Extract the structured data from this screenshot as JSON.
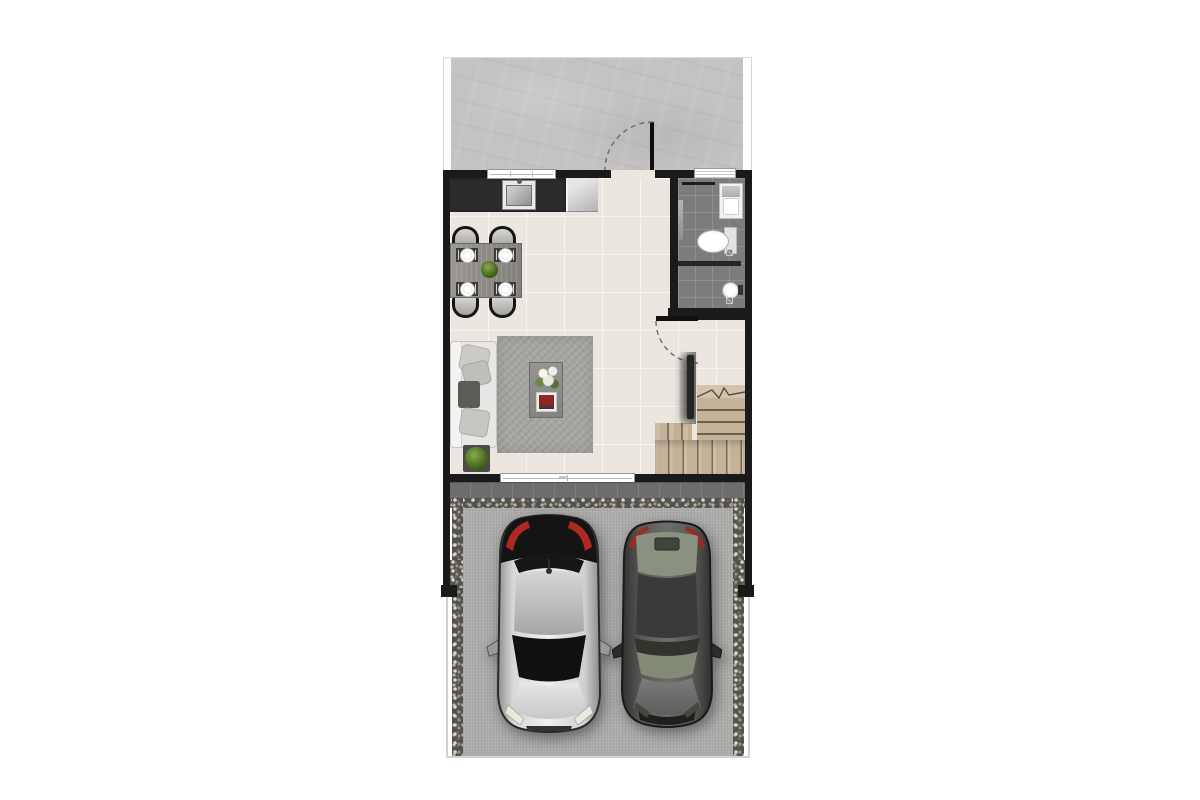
{
  "scene": {
    "type": "architectural floor plan",
    "view": "top-down",
    "description": "Ground-floor plan of a townhouse: rear concrete patio at top, open living-dining room with kitchen counter, bathroom at upper right, wooden staircase at lower right, and a front driveway with two parked cars"
  },
  "colors": {
    "wall": "#1a1a1a",
    "floor": "#ebe7e0",
    "patio": "#c4c3c1",
    "bath": "#7c7c7c",
    "counter": "#2d2c2c",
    "wood": "#c4b299",
    "rug": "#a6a5a2",
    "tile": "#6d6d6d",
    "gravel": "#54524c",
    "drive": "#adadac",
    "taillight_red": "#b02822",
    "plant_green": "#47661f",
    "car_silver": "#d8d8d8",
    "car_gray": "#4a4a48"
  },
  "areas": [
    {
      "name": "backyard-patio"
    },
    {
      "name": "living-dining-room"
    },
    {
      "name": "kitchen"
    },
    {
      "name": "bathroom"
    },
    {
      "name": "staircase"
    },
    {
      "name": "porch-strip"
    },
    {
      "name": "driveway"
    }
  ],
  "fixtures": [
    {
      "name": "patio-door",
      "state": "swing-arc-shown"
    },
    {
      "name": "kitchen-window"
    },
    {
      "name": "bathroom-louver-window"
    },
    {
      "name": "living-room-sliding-window"
    },
    {
      "name": "kitchen-counter-with-sink"
    },
    {
      "name": "refrigerator"
    },
    {
      "name": "dining-table",
      "seats": 4,
      "place_settings": 4
    },
    {
      "name": "sofa-with-pillows"
    },
    {
      "name": "coffee-table-with-flowers-and-magazines"
    },
    {
      "name": "area-rug"
    },
    {
      "name": "potted-plant",
      "count": 2
    },
    {
      "name": "toilet"
    },
    {
      "name": "vanity-sink"
    },
    {
      "name": "shower-with-drains"
    },
    {
      "name": "stair-break-line"
    }
  ],
  "vehicles": [
    {
      "name": "silver-hatchback",
      "facing": "down"
    },
    {
      "name": "gray-sedan",
      "facing": "down"
    }
  ]
}
